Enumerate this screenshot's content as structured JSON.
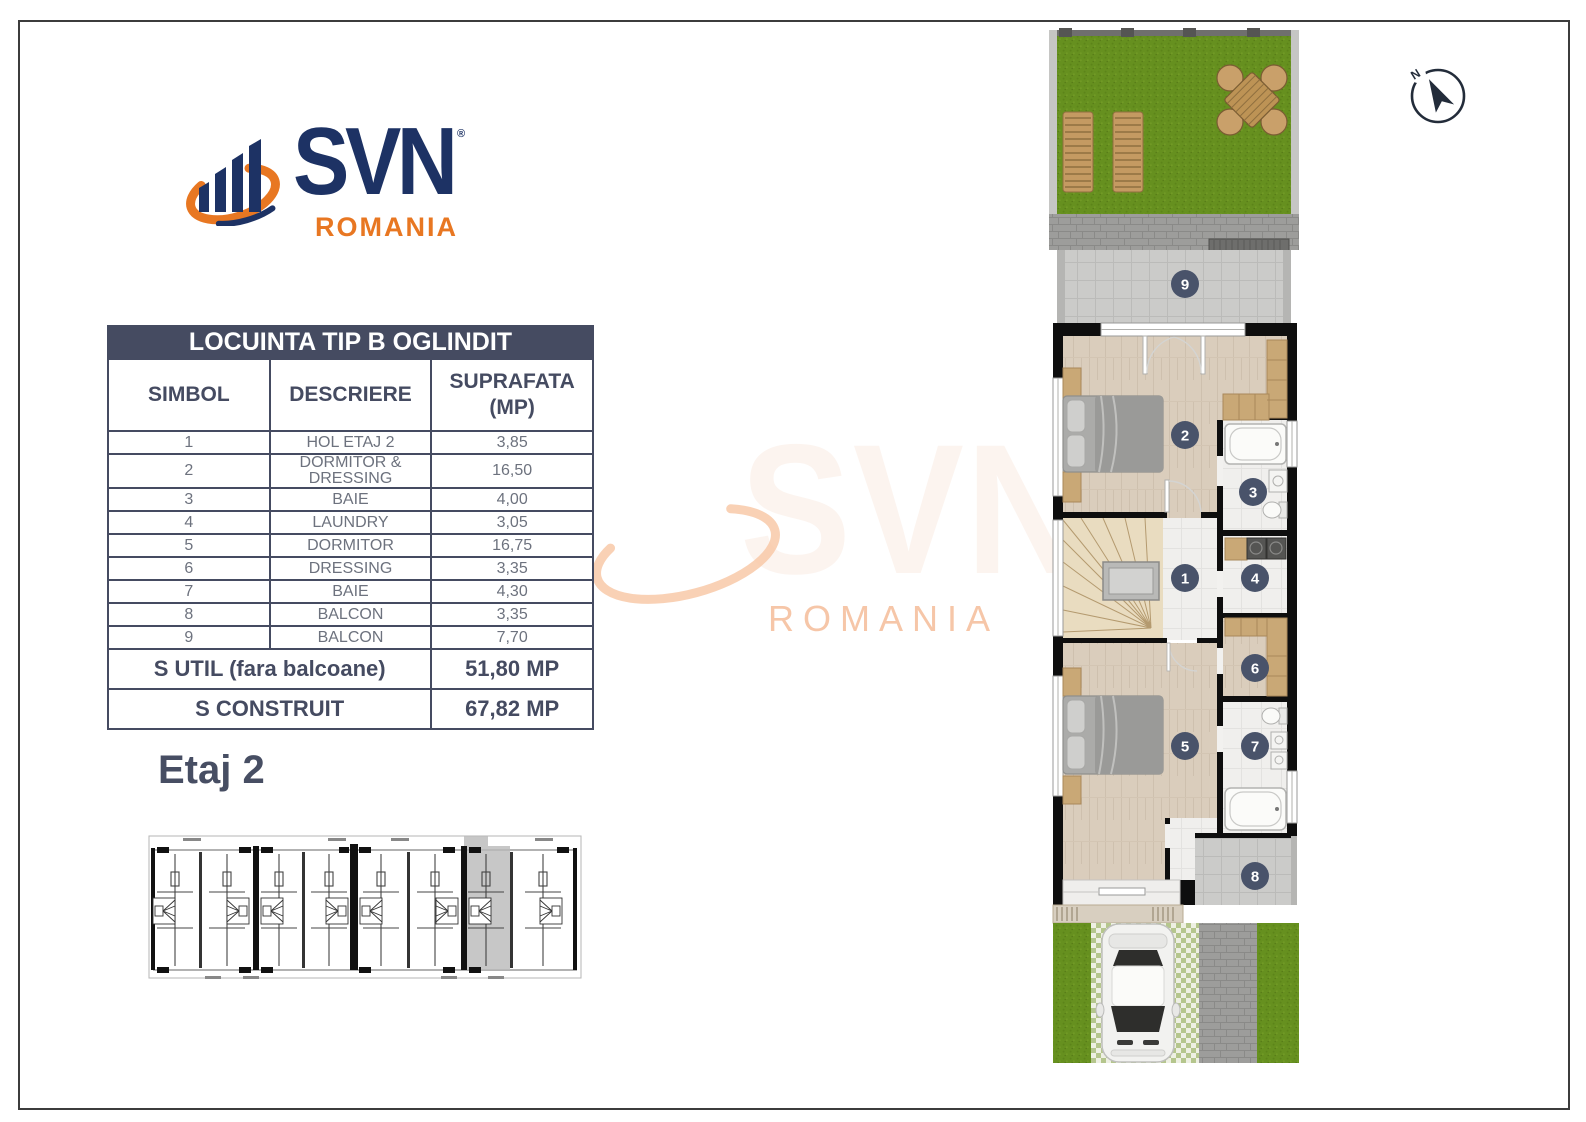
{
  "logo": {
    "brand": "SVN",
    "registered": "®",
    "region": "ROMANIA"
  },
  "table": {
    "title": "LOCUINTA TIP B OGLINDIT",
    "columns": {
      "simbol": "SIMBOL",
      "descriere": "DESCRIERE",
      "suprafata_line1": "SUPRAFATA",
      "suprafata_line2": "(MP)"
    },
    "rows": [
      {
        "simbol": "1",
        "descriere": "HOL ETAJ 2",
        "suprafata": "3,85"
      },
      {
        "simbol": "2",
        "descriere": "DORMITOR & DRESSING",
        "suprafata": "16,50"
      },
      {
        "simbol": "3",
        "descriere": "BAIE",
        "suprafata": "4,00"
      },
      {
        "simbol": "4",
        "descriere": "LAUNDRY",
        "suprafata": "3,05"
      },
      {
        "simbol": "5",
        "descriere": "DORMITOR",
        "suprafata": "16,75"
      },
      {
        "simbol": "6",
        "descriere": "DRESSING",
        "suprafata": "3,35"
      },
      {
        "simbol": "7",
        "descriere": "BAIE",
        "suprafata": "4,30"
      },
      {
        "simbol": "8",
        "descriere": "BALCON",
        "suprafata": "3,35"
      },
      {
        "simbol": "9",
        "descriere": "BALCON",
        "suprafata": "7,70"
      }
    ],
    "totals": [
      {
        "label": "S UTIL (fara balcoane)",
        "value": "51,80 MP"
      },
      {
        "label": "S CONSTRUIT",
        "value": "67,82 MP"
      }
    ]
  },
  "floor": {
    "label": "Etaj 2"
  },
  "compass": {
    "north_label": "N"
  },
  "watermark": {
    "brand": "SVN",
    "region": "ROMANIA"
  },
  "plan": {
    "room_labels": [
      "1",
      "2",
      "3",
      "4",
      "5",
      "6",
      "7",
      "8",
      "9"
    ]
  },
  "colors": {
    "navy": "#1d3264",
    "orange": "#e87722",
    "slate": "#454b61",
    "grass": "#66901f",
    "label_circle": "#49536a"
  }
}
